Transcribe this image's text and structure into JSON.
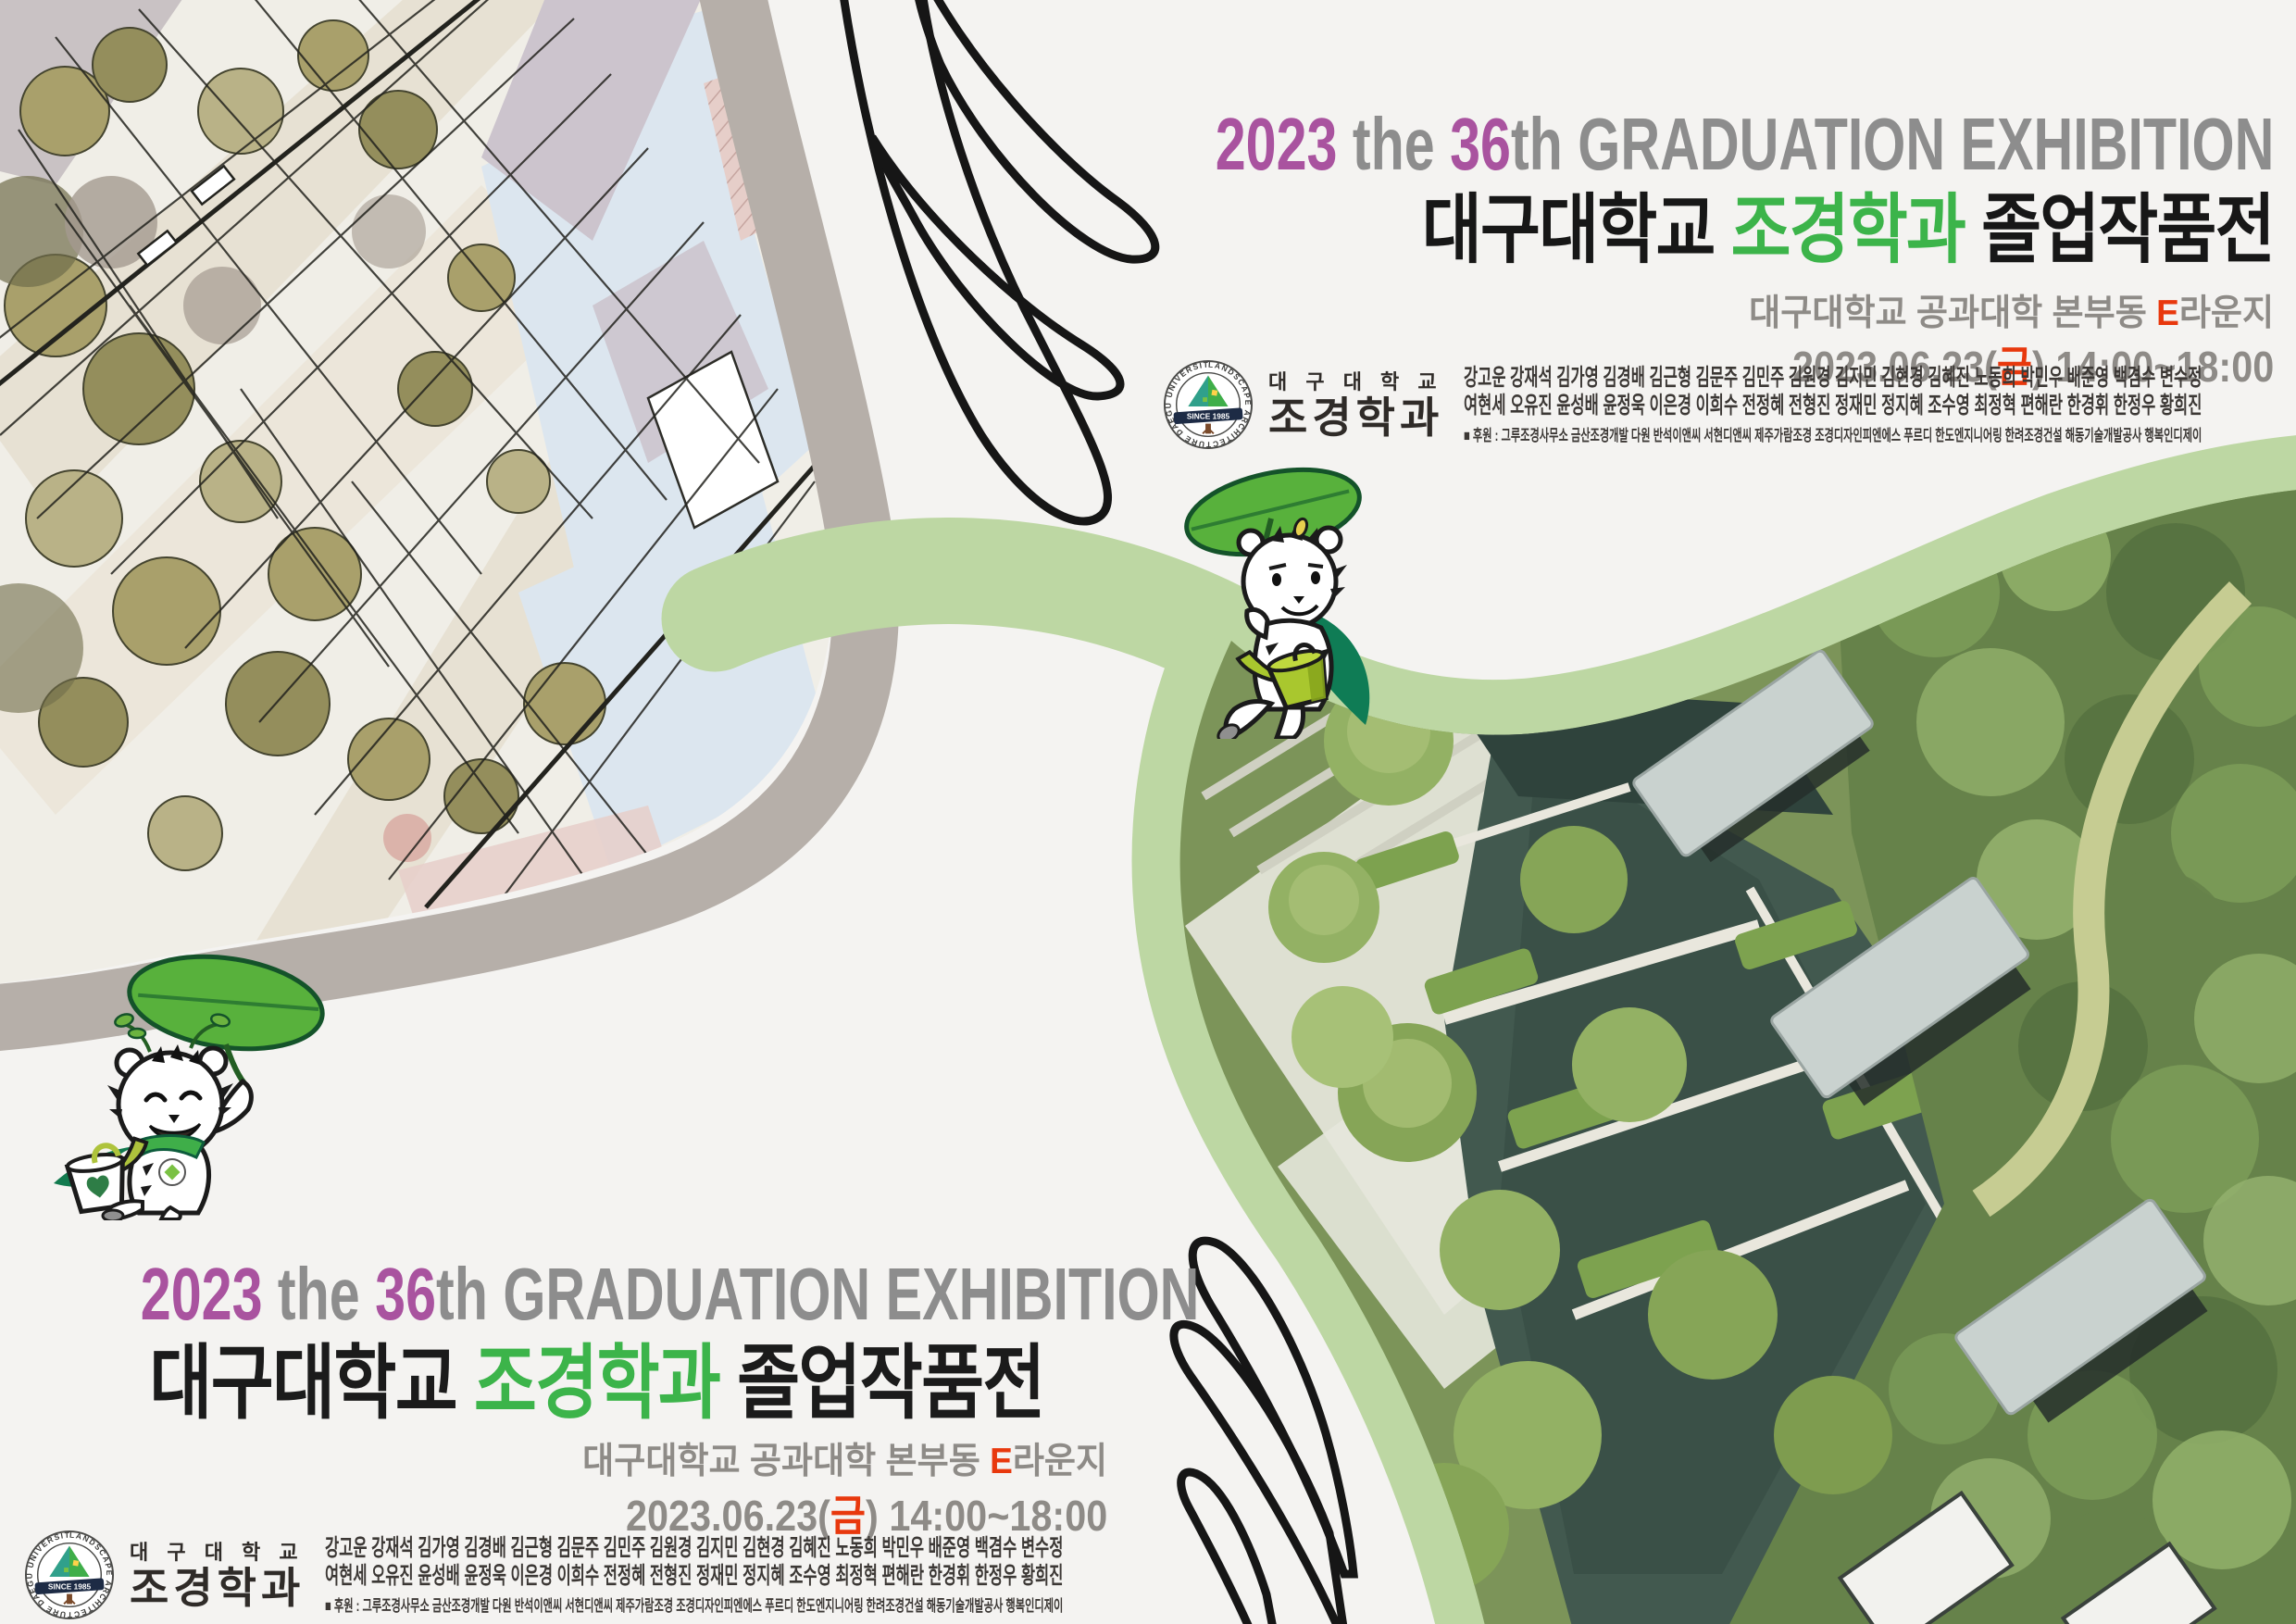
{
  "poster": {
    "title_en": {
      "year": "2023",
      "mid": " the ",
      "num": "36",
      "suffix": "th ",
      "rest": "GRADUATION EXHIBITION"
    },
    "title_kr": {
      "univ": "대구대학교 ",
      "dept": "조경학과",
      "event": " 졸업작품전"
    },
    "venue": {
      "pre": "대구대학교 공과대학 본부동 ",
      "highlight": "E",
      "post": "라운지"
    },
    "datetime": {
      "pre": "2023.06.23(",
      "highlight": "금",
      "post": ") 14:00~18:00"
    },
    "logo": {
      "ring_text": "LANDSCAPE ARCHITECTURE DAEGU UNIVERSITY",
      "since": "SINCE 1985",
      "univ_spaced": "대 구 대 학 교",
      "dept": "조경학과"
    },
    "credits": {
      "names_row1": "강고운 강재석 김가영 김경배 김근형 김문주 김민주 김원경 김지민 김현경 김혜진 노동희 박민우 배준영 백겸수 변수정",
      "names_row2": "여현세 오유진 윤성배 윤정욱 이은경 이희수 전정혜 전형진 정재민 정지혜 조수영 최정혁 편해란 한경휘 한정우 황희진",
      "sponsors": "■  후원 : 그루조경사무소   금산조경개발   다원   반석이앤씨   서현디앤씨   제주가람조경   조경디자인피엔에스   푸르디   한도엔지니어링   한려조경건설   해동기술개발공사   행복인디제이"
    },
    "colors": {
      "accent_purple": "#a9539f",
      "accent_green": "#3cb44a",
      "accent_red": "#e8380d",
      "title_gray": "#8d8d8d",
      "ribbon_green": "#bdd7a3",
      "band_taupe": "#b6afa9"
    }
  }
}
